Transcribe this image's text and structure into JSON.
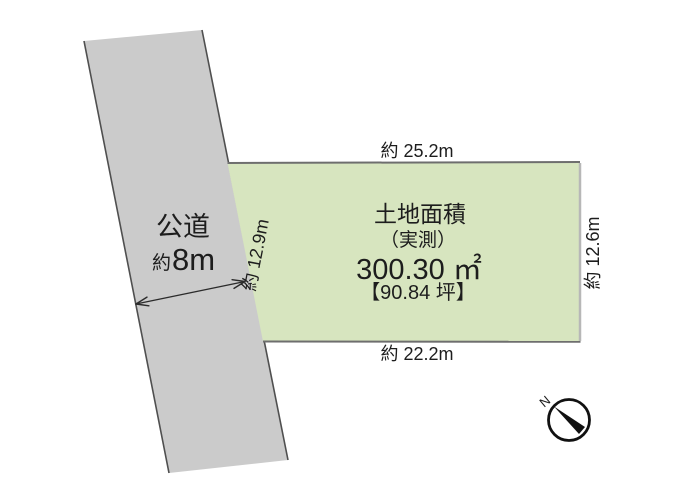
{
  "road": {
    "name_label": "公道",
    "width_prefix": "約",
    "width_value": "8m"
  },
  "parcel": {
    "title": "土地面積",
    "measure_type": "（実測）",
    "area_sqm": "300.30 ㎡",
    "area_tsubo": "【90.84 坪】",
    "dim_top": "約 25.2m",
    "dim_bottom": "約 22.2m",
    "dim_left": "約 12.9m",
    "dim_right": "約 12.6m"
  },
  "compass": {
    "north_label": "N"
  },
  "colors": {
    "road_fill": "#cbcbcb",
    "parcel_fill": "#d7e5bf",
    "outline_dark": "#4f4f4f",
    "parcel_border_dark": "#6e6e6e",
    "parcel_border_light": "#b7b7b7",
    "text": "#1d1d1d"
  }
}
